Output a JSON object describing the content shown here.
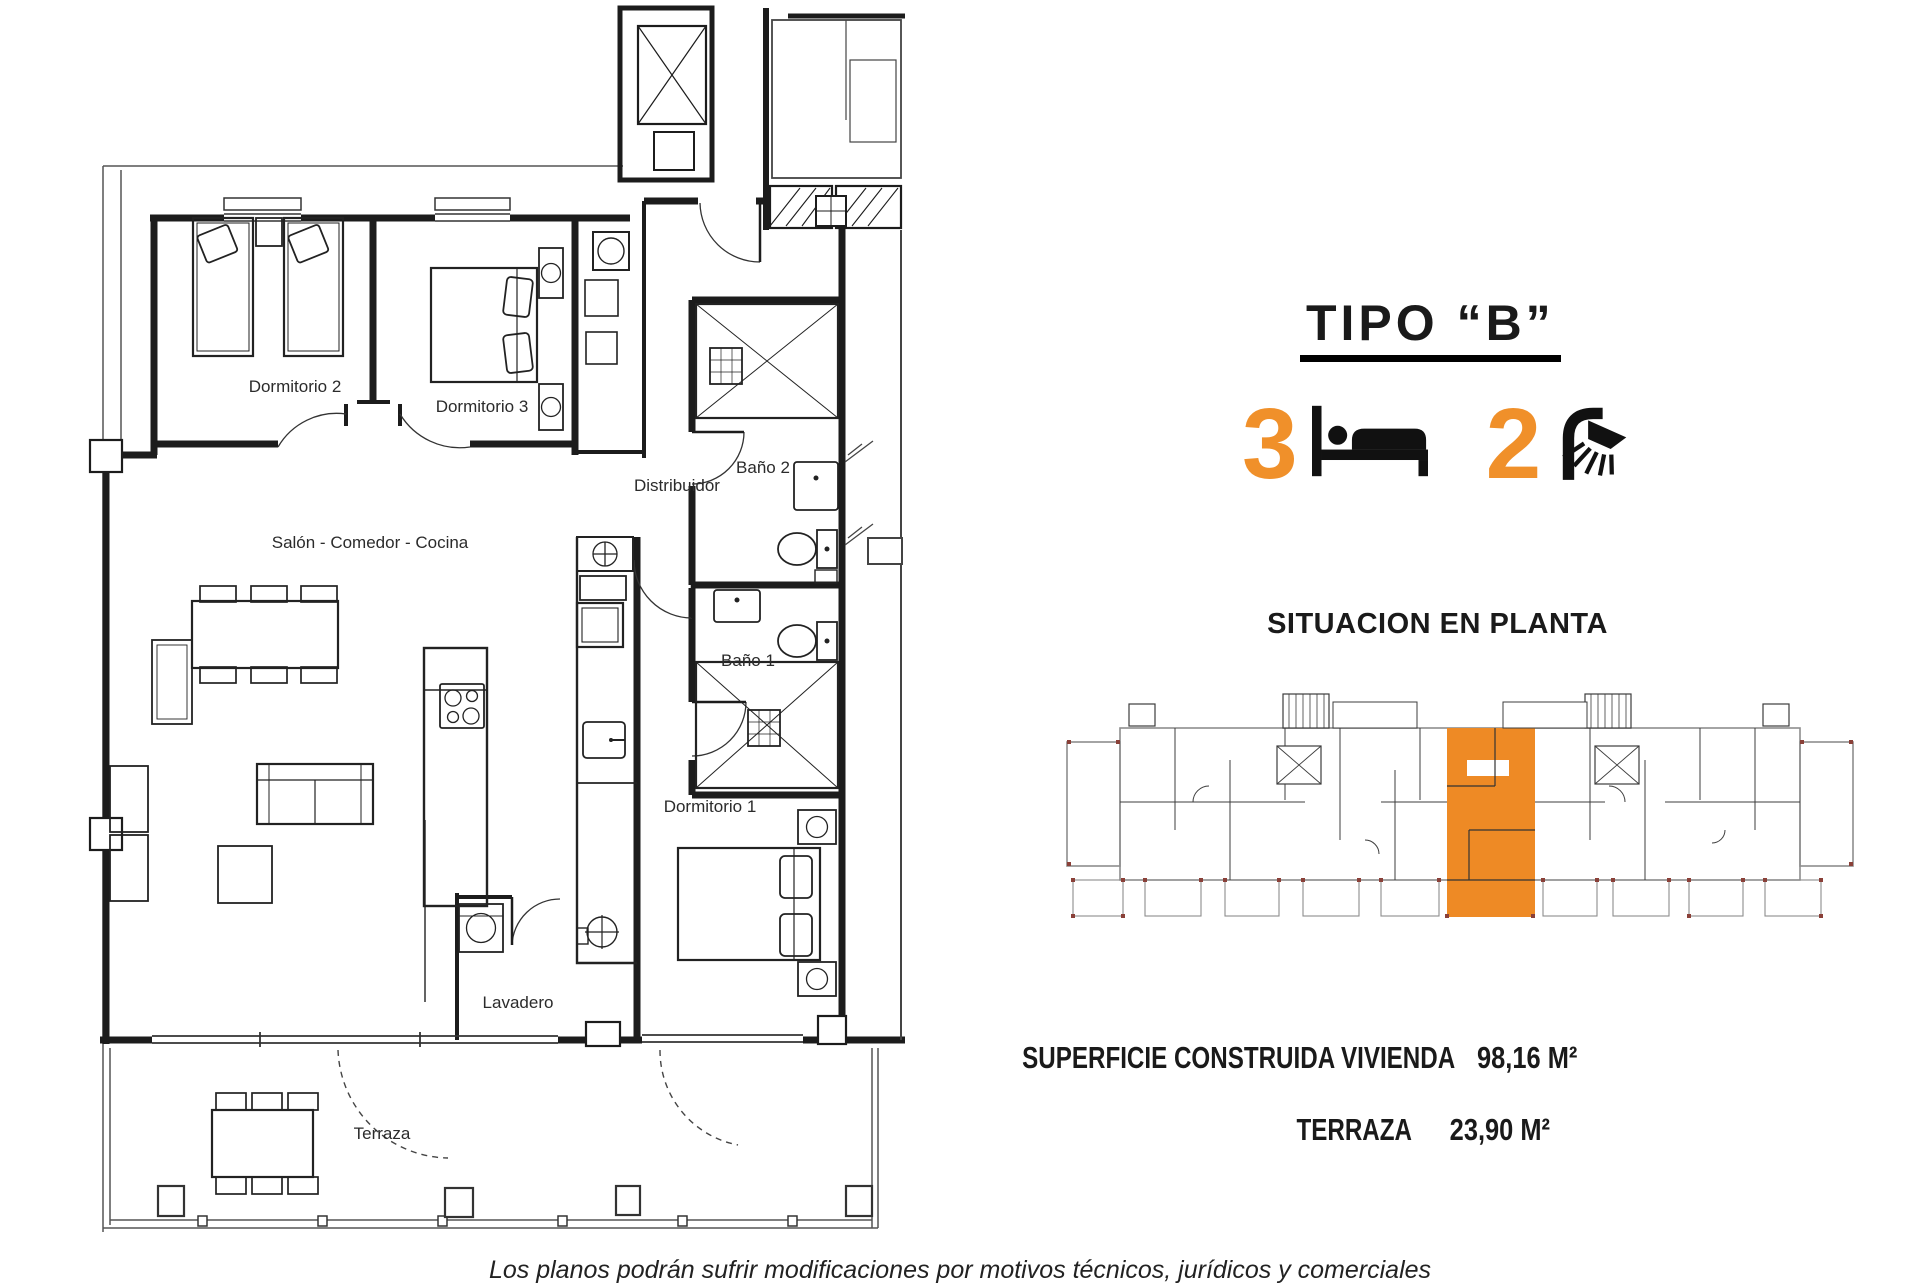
{
  "title": "TIPO “B”",
  "features": {
    "bedrooms": "3",
    "bathrooms": "2",
    "bedrooms_icon": "bed-icon",
    "bathrooms_icon": "shower-icon"
  },
  "situation": {
    "heading": "SITUACION EN PLANTA"
  },
  "areas": {
    "rows": [
      {
        "label": "SUPERFICIE CONSTRUIDA VIVIENDA",
        "value": "98,16 M²"
      },
      {
        "label": "TERRAZA",
        "value": "23,90 M²"
      }
    ]
  },
  "floorplan": {
    "rooms": {
      "dormitorio2": "Dormitorio 2",
      "dormitorio3": "Dormitorio 3",
      "bano2": "Baño 2",
      "distribuidor": "Distribuidor",
      "salon": "Salón - Comedor - Cocina",
      "bano1": "Baño 1",
      "dormitorio1": "Dormitorio 1",
      "lavadero": "Lavadero",
      "terraza": "Terraza"
    }
  },
  "disclaimer": "Los planos podrán sufrir modificaciones por motivos técnicos, jurídicos y comerciales",
  "colors": {
    "accent_orange": "#F0902A",
    "highlight_unit_orange": "#EE8A25",
    "plan_line": "#1c1c1c",
    "mini_plan_line": "#8d8d8d",
    "column_marker": "#8a4038"
  }
}
